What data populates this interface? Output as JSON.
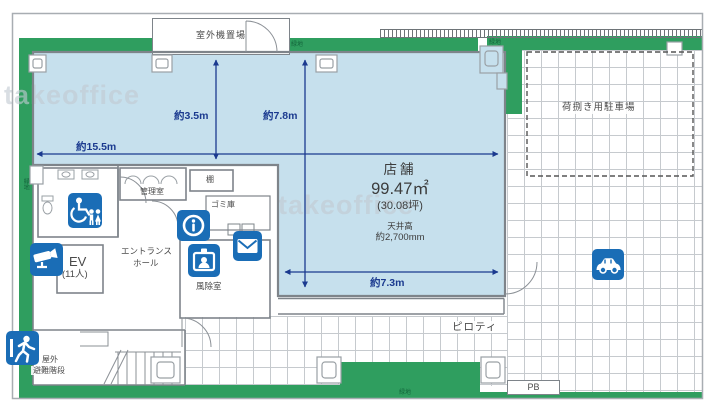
{
  "watermark": "takeoffice",
  "store": {
    "name": "店舗",
    "area_m2": "99.47㎡",
    "area_tsubo": "(30.08坪)",
    "ceiling_title": "天井高",
    "ceiling_height": "約2,700mm"
  },
  "dimensions": {
    "top_width": "約15.5m",
    "left_depth": "約3.5m",
    "center_depth": "約7.8m",
    "bottom_width": "約7.3m"
  },
  "labels": {
    "outdoor_unit": "室外機置場",
    "green_strip": "緑地",
    "loading_parking": "荷捌き用駐車場",
    "control_room": "管理室",
    "shelf": "棚",
    "garbage_room": "ゴミ庫",
    "entrance_hall_1": "エントランス",
    "entrance_hall_2": "ホール",
    "elevator": "EV",
    "elevator_capacity": "(11人)",
    "windbreak_room": "風除室",
    "outdoor_stairs_1": "屋外",
    "outdoor_stairs_2": "避難階段",
    "piloti": "ピロティ",
    "pb": "PB"
  },
  "icons": [
    {
      "name": "accessible-restroom-icon"
    },
    {
      "name": "security-camera-icon"
    },
    {
      "name": "info-icon"
    },
    {
      "name": "id-badge-icon"
    },
    {
      "name": "mail-icon"
    },
    {
      "name": "emergency-exit-icon"
    },
    {
      "name": "car-icon"
    }
  ],
  "colors": {
    "green": "#2f9e5f",
    "store_blue": "#c6e0ed",
    "icon_blue": "#1a6db6",
    "dimension_navy": "#1b3a8f"
  }
}
